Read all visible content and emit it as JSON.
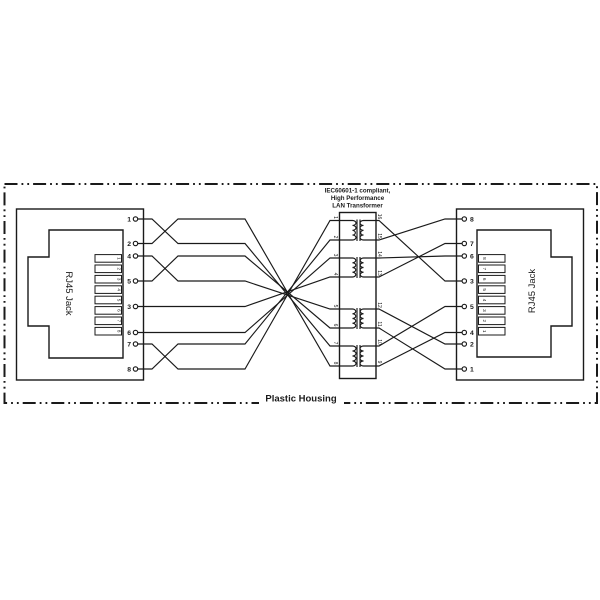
{
  "diagram": {
    "title_lines": [
      "IEC60601-1 compliant,",
      "High Performance",
      "LAN Transformer"
    ],
    "housing_label": "Plastic Housing",
    "left_jack": {
      "label": "RJ45 Jack",
      "slot_numbers": [
        "1",
        "2",
        "3",
        "4",
        "5",
        "6",
        "7",
        "8"
      ],
      "terminal_numbers": [
        "1",
        "2",
        "4",
        "5",
        "3",
        "6",
        "7",
        "8"
      ]
    },
    "right_jack": {
      "label": "RJ45 Jack",
      "slot_numbers": [
        "8",
        "7",
        "6",
        "5",
        "4",
        "3",
        "2",
        "1"
      ],
      "terminal_numbers": [
        "8",
        "7",
        "6",
        "3",
        "5",
        "4",
        "2",
        "1"
      ]
    },
    "transformer": {
      "left_pin_numbers": [
        "1",
        "2",
        "3",
        "4",
        "5",
        "6",
        "7",
        "8"
      ],
      "right_pin_numbers": [
        "16",
        "15",
        "14",
        "13",
        "12",
        "11",
        "10",
        "9"
      ]
    },
    "colors": {
      "line": "#1a1a1a",
      "background": "#ffffff"
    }
  }
}
